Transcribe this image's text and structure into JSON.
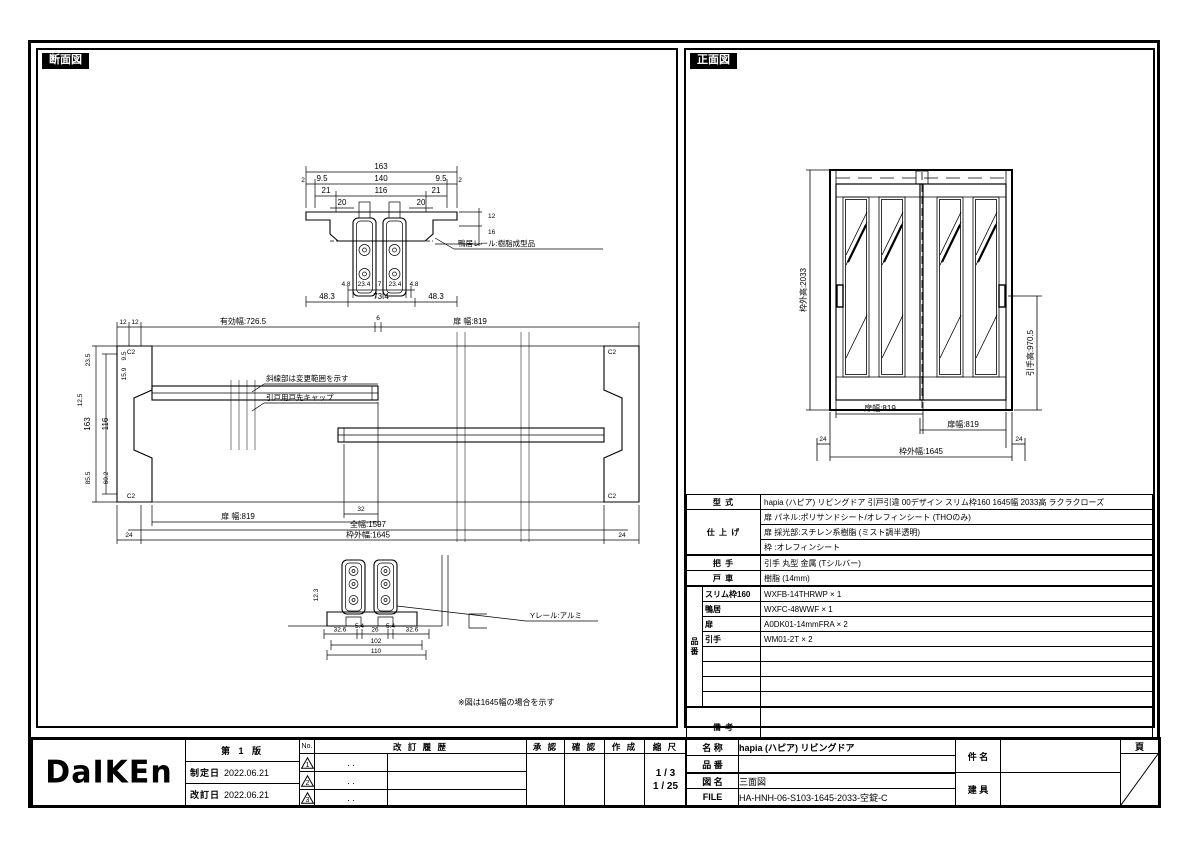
{
  "titles": {
    "section": "断面図",
    "front": "正面図"
  },
  "section_view": {
    "head": {
      "d163": "163",
      "d2l": "2",
      "d95l": "9.5",
      "d140": "140",
      "d95r": "9.5",
      "d2r": "2",
      "d21l": "21",
      "d116": "116",
      "d21r": "21",
      "d20l": "20",
      "d20r": "20",
      "d12": "12",
      "d16": "16",
      "d48l": "4.8",
      "d234l": "23.4",
      "d7": "7",
      "d234r": "23.4",
      "d48r": "4.8",
      "d483l": "48.3",
      "d734": "73.4",
      "d483r": "48.3",
      "rail_label": "鴨居レール:樹脂成型品"
    },
    "plan": {
      "d12a": "12",
      "d12b": "12",
      "deff": "有効幅:726.5",
      "d6": "6",
      "ddoor_t": "扉 幅:819",
      "d163": "163",
      "d116": "116",
      "d235": "23.5",
      "d95": "9.5",
      "d159": "15.9",
      "d125": "12.5",
      "d855": "85.5",
      "d602": "60.2",
      "c2": "C2",
      "note_hatch": "斜線部は変更範囲を示す",
      "cap_label": "引戸用戸先キャップ",
      "d24l": "24",
      "d24r": "24",
      "ddoor_b": "扉 幅:819",
      "d32": "32",
      "d1597": "全幅:1597",
      "d1645": "枠外幅:1645"
    },
    "sill": {
      "rail_label": "Yレール:アルミ",
      "d123": "12.3",
      "d326l": "32.6",
      "d54l": "5.4",
      "d26": "26",
      "d54r": "5.4",
      "d326r": "32.6",
      "d102": "102",
      "d110": "110"
    },
    "note": "※図は1645幅の場合を示す"
  },
  "front_view": {
    "dheight": "枠外高:2033",
    "dhandle": "引手高:970.5",
    "ddoorl": "扉幅:819",
    "ddoorr": "扉幅:819",
    "d24l": "24",
    "d24r": "24",
    "dwidth": "枠外幅:1645"
  },
  "spec": {
    "model_label": "型 式",
    "model_value": "hapia (ハピア)  リビングドア  引戸引違  00デザイン  スリム枠160  1645幅  2033高  ラクラクローズ",
    "finish_label": "仕 上 げ",
    "finish_row1": "扉 パネル:ポリサンドシート/オレフィンシート (THOのみ)",
    "finish_row2": "扉 採光部:スチレン系樹脂 (ミスト調半透明)",
    "finish_row3": "枠         :オレフィンシート",
    "handle_label": "把 手",
    "handle_value": "引手 丸型 金属 (Tシルバー)",
    "roller_label": "戸 車",
    "roller_value": "樹脂 (14mm)",
    "parts_label": "品 番",
    "parts": [
      {
        "name": "スリム枠160",
        "value": "WXFB-14THRWP × 1"
      },
      {
        "name": "鴨居",
        "value": "WXFC-48WWF × 1"
      },
      {
        "name": "扉",
        "value": "A0DK01-14mmFRA × 2"
      },
      {
        "name": "引手",
        "value": "WM01-2T × 2"
      },
      {
        "name": "",
        "value": ""
      },
      {
        "name": "",
        "value": ""
      },
      {
        "name": "",
        "value": ""
      },
      {
        "name": "",
        "value": ""
      }
    ],
    "remarks_label": "備 考"
  },
  "title_block": {
    "logo": "DaIKEn",
    "edition": "第 1 版",
    "enacted_label": "制定日",
    "enacted_date": "2022.06.21",
    "revised_label": "改訂日",
    "revised_date": "2022.06.21",
    "no_label": "No.",
    "history_label": "改 訂 履 歴",
    "rev_rows": [
      {
        "no": "1",
        "date": ".  ."
      },
      {
        "no": "2",
        "date": ".  ."
      },
      {
        "no": "3",
        "date": ".  ."
      }
    ],
    "approve_label": "承 認",
    "check_label": "確 認",
    "create_label": "作 成",
    "scale_label": "縮 尺",
    "scale_1": "1 / 3",
    "scale_2": "1 / 25",
    "name_label": "名 称",
    "name_value": "hapia (ハピア)  リビングドア",
    "part_label": "品 番",
    "part_value": "",
    "drawing_label": "図 名",
    "drawing_value": "三面図",
    "file_label": "FILE",
    "file_value": "HA-HNH-06-S103-1645-2033-空錠-C",
    "subject_label": "件 名",
    "subject_value": "",
    "fitting_label": "建 具",
    "fitting_value": "",
    "page_label": "頁"
  }
}
